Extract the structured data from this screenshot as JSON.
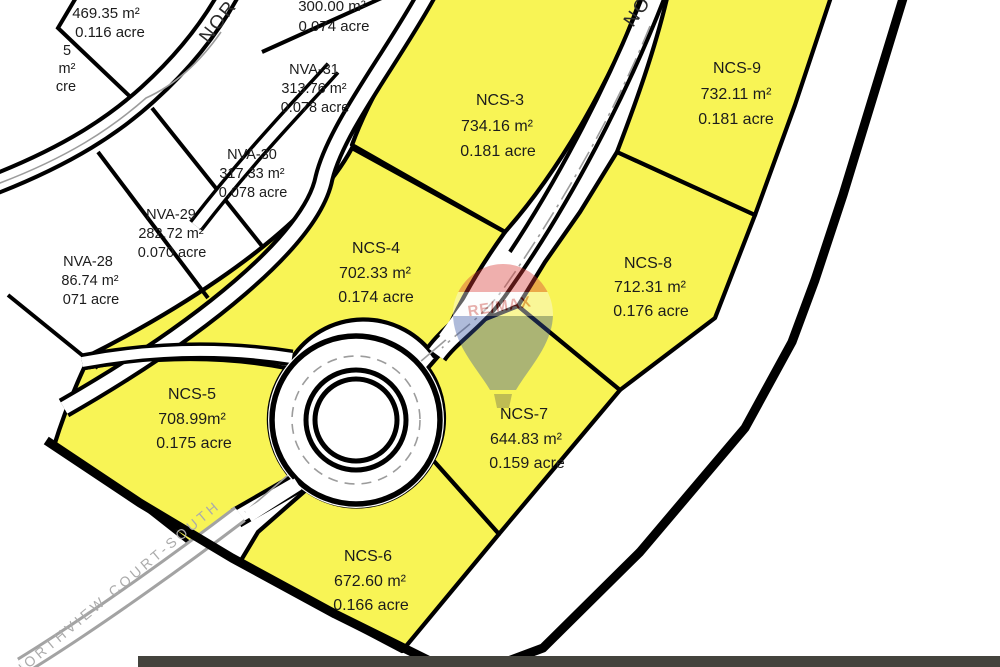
{
  "map_title": "Subdivision plat map with lot areas",
  "streets": {
    "upper_left_partial": "NOR",
    "upper_right_partial": "NO",
    "unbuilt_court": "NORTHVIEW COURT-SOUTH"
  },
  "lots": {
    "yellow": [
      {
        "id": "NCS-3",
        "area": "734.16 m²",
        "acreage": "0.181 acre"
      },
      {
        "id": "NCS-4",
        "area": "702.33 m²",
        "acreage": "0.174 acre"
      },
      {
        "id": "NCS-5",
        "area": "708.99m²",
        "acreage": "0.175 acre"
      },
      {
        "id": "NCS-6",
        "area": "672.60 m²",
        "acreage": "0.166 acre"
      },
      {
        "id": "NCS-7",
        "area": "644.83 m²",
        "acreage": "0.159 acre"
      },
      {
        "id": "NCS-8",
        "area": "712.31 m²",
        "acreage": "0.176 acre"
      },
      {
        "id": "NCS-9",
        "area": "732.11 m²",
        "acreage": "0.181 acre"
      }
    ],
    "white": [
      {
        "id": "",
        "area": "469.35 m²",
        "acreage": "0.116 acre"
      },
      {
        "id": "",
        "area": "300.00 m²",
        "acreage": "0.074 acre"
      },
      {
        "id": "NVA-31",
        "area": "313.76 m²",
        "acreage": "0.078 acre"
      },
      {
        "id": "NVA-30",
        "area": "317.33 m²",
        "acreage": "0.078 acre"
      },
      {
        "id": "NVA-29",
        "area": "282.72 m²",
        "acreage": "0.070 acre"
      },
      {
        "id": "NVA-28",
        "area": "86.74 m²",
        "acreage": "071 acre"
      },
      {
        "fragments": [
          "5",
          "m²",
          "cre"
        ]
      }
    ]
  },
  "watermark": {
    "brand": "RE/MAX",
    "balloon_red": "#d93a35",
    "balloon_white": "#fbfbfb",
    "balloon_blue": "#3a56a4",
    "text_color": "#c23630"
  },
  "colors": {
    "lot_fill_yellow": "#f8f455",
    "boundary_black": "#000000",
    "road_centerline_gray": "#9c9c9c",
    "unbuilt_road_gray": "#a3a3a3",
    "street_label_gray": "#ababab",
    "bottom_strip": "#44433d"
  }
}
